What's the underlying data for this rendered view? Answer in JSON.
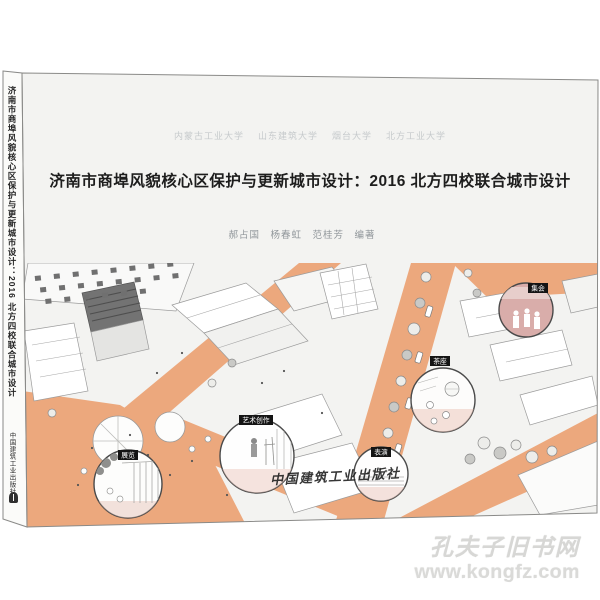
{
  "watermark": {
    "site_name": "孔夫子旧书网",
    "site_url": "www.kongfz.com"
  },
  "book": {
    "front_cover": {
      "universities": [
        {
          "label": "内蒙古工业大学"
        },
        {
          "label": "山东建筑大学"
        },
        {
          "label": "烟台大学"
        },
        {
          "label": "北方工业大学"
        }
      ],
      "title": "济南市商埠风貌核心区保护与更新城市设计：2016 北方四校联合城市设计",
      "authors": "郝占国　杨春虹　范桂芳　编著",
      "publisher_script": "中国建筑工业出版社"
    },
    "spine": {
      "title": "济南市商埠风貌核心区保护与更新城市设计：2016 北方四校联合城市设计",
      "publisher": "中国建筑工业出版社"
    },
    "illustration": {
      "callouts": [
        {
          "label": "集会"
        },
        {
          "label": "茶座"
        },
        {
          "label": "艺术创作"
        },
        {
          "label": "展览"
        },
        {
          "label": "表演"
        }
      ],
      "colors": {
        "street_orange": "#eca87d",
        "callout_pink": "#d9adaa",
        "cover_background": "#f3f3f1",
        "title_text": "#1d1d1d",
        "watermark_gray": "#d7d7d5"
      }
    }
  }
}
